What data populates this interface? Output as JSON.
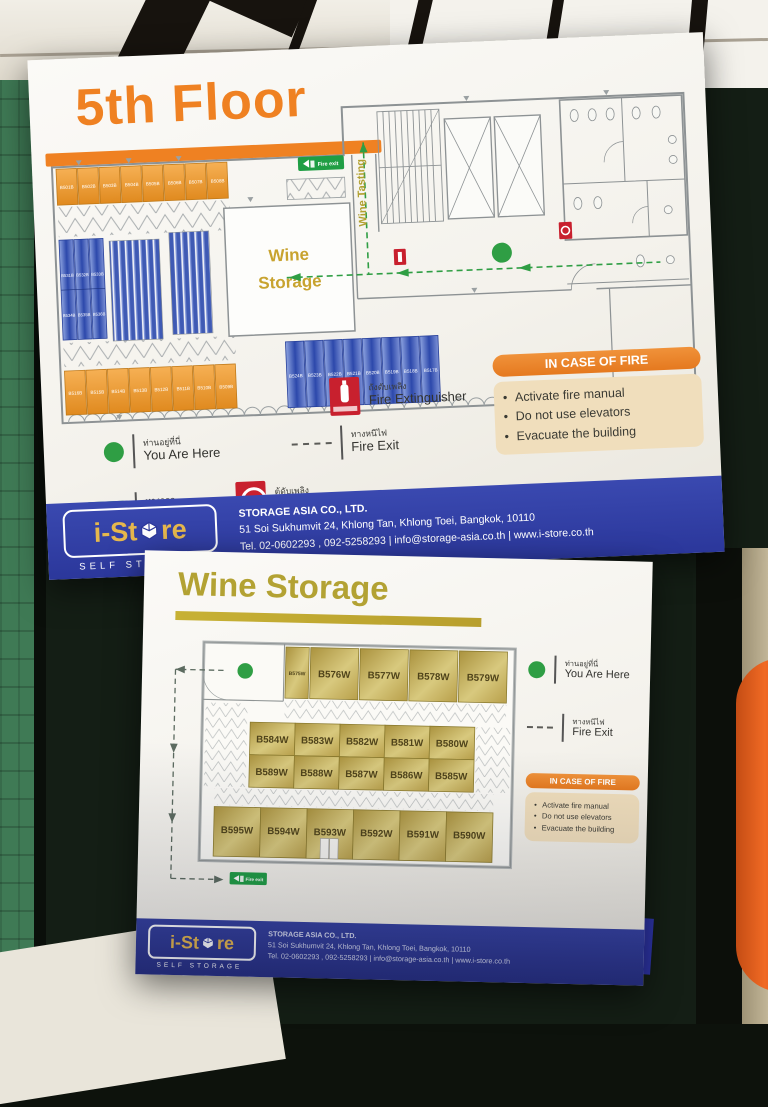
{
  "sign_5th": {
    "title": "5th Floor",
    "plan": {
      "room_label_line1": "Wine",
      "room_label_line2": "Storage",
      "wine_tasting": "Wine Tasting",
      "fire_exit_badge": "Fire exit",
      "units_orange_top": [
        "B501B",
        "B502B",
        "B503B",
        "B504B",
        "B505B",
        "B506B",
        "B507B",
        "B508B"
      ],
      "units_orange_bottom": [
        "B516B",
        "B515B",
        "B514B",
        "B513B",
        "B512B",
        "B511B",
        "B510B",
        "B509B"
      ],
      "units_blue_row": [
        "B524B",
        "B523B",
        "B522B",
        "B521B",
        "B520B",
        "B519B",
        "B518B",
        "B517B"
      ],
      "units_blue_left": [
        "B531B",
        "B532B",
        "B533B",
        "B534B",
        "B535B",
        "B536B"
      ]
    },
    "legend": {
      "you_are_here_th": "ท่านอยู่ที่นี่",
      "you_are_here_en": "You Are Here",
      "fire_exit_th": "ทางหนีไฟ",
      "fire_exit_en": "Fire Exit",
      "extinguisher_th": "ถังดับเพลิง",
      "extinguisher_en": "Fire Extinguisher",
      "exit_th": "ทางออก",
      "exit_en": "Exit",
      "hose_th": "ตู้ดับเพลิง",
      "hose_en": "Fire Hose Cabinet"
    },
    "notice": {
      "title": "IN CASE OF FIRE",
      "items": [
        "Activate fire manual",
        "Do not use elevators",
        "Evacuate the building"
      ]
    },
    "footer": {
      "brand_left": "i-St",
      "brand_right": "re",
      "brand_sub": "SELF STORAGE",
      "company": "STORAGE ASIA CO., LTD.",
      "address": "51 Soi Sukhumvit 24, Khlong Tan, Khlong Toei, Bangkok, 10110",
      "contact": "Tel. 02-0602293 , 092-5258293 | info@storage-asia.co.th | www.i-store.co.th"
    }
  },
  "sign_wine": {
    "title": "Wine Storage",
    "fire_exit_badge": "Fire exit",
    "units_top": [
      "B575W",
      "B576W",
      "B577W",
      "B578W",
      "B579W"
    ],
    "units_mid1": [
      "B584W",
      "B583W",
      "B582W",
      "B581W",
      "B580W"
    ],
    "units_mid2": [
      "B589W",
      "B588W",
      "B587W",
      "B586W",
      "B585W"
    ],
    "units_bottom": [
      "B595W",
      "B594W",
      "B593W",
      "B592W",
      "B591W",
      "B590W"
    ],
    "legend": {
      "you_are_here_th": "ท่านอยู่ที่นี่",
      "you_are_here_en": "You Are Here",
      "fire_exit_th": "ทางหนีไฟ",
      "fire_exit_en": "Fire Exit"
    },
    "notice": {
      "title": "IN CASE OF FIRE",
      "items": [
        "Activate fire manual",
        "Do not use elevators",
        "Evacuate the building"
      ]
    },
    "footer": {
      "brand_left": "i-St",
      "brand_right": "re",
      "brand_sub": "SELF STORAGE",
      "company": "STORAGE ASIA CO., LTD.",
      "address": "51 Soi Sukhumvit 24, Khlong Tan, Khlong Toei, Bangkok, 10110",
      "contact": "Tel. 02-0602293 , 092-5258293 | info@storage-asia.co.th | www.i-store.co.th"
    }
  },
  "colors": {
    "accent_orange": "#ef8122",
    "accent_olive": "#b3a233",
    "brand_blue": "#2b379b",
    "unit_orange": "#f0a23c",
    "unit_blue": "#3d58b2",
    "unit_gold": "#c9b65a",
    "marker_green": "#2f9e44",
    "marker_red": "#c8202e"
  }
}
